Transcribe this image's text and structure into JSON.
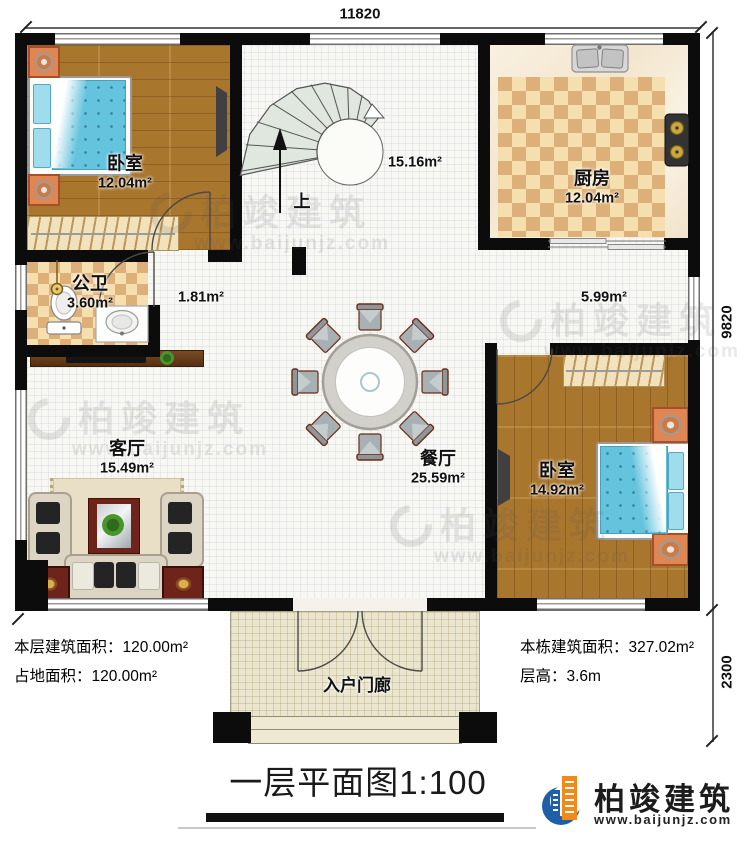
{
  "dimensions": {
    "width_top": "11820",
    "height_main": "9820",
    "height_porch": "2300"
  },
  "rooms": {
    "bedroom1": {
      "label": "卧室",
      "area": "12.04m²"
    },
    "stair_hall": {
      "area": "15.16m²",
      "up": "上"
    },
    "kitchen": {
      "label": "厨房",
      "area": "12.04m²"
    },
    "bathroom": {
      "label": "公卫",
      "area": "3.60m²"
    },
    "corridor_small": {
      "area": "1.81m²"
    },
    "corridor_right": {
      "area": "5.99m²"
    },
    "living_room": {
      "label": "客厅",
      "area": "15.49m²"
    },
    "dining_room": {
      "label": "餐厅",
      "area": "25.59m²"
    },
    "bedroom2": {
      "label": "卧室",
      "area": "14.92m²"
    },
    "porch": {
      "label": "入户门廊"
    }
  },
  "annotations": {
    "floor_area": "本层建筑面积：120.00m²",
    "land_area": "占地面积：120.00m²",
    "total_area": "本栋建筑面积：327.02m²",
    "floor_height": "层高：3.6m"
  },
  "title": "一层平面图1:100",
  "brand": {
    "name": "柏竣建筑",
    "url": "www.baijunjz.com"
  },
  "watermark": {
    "name": "柏竣建筑",
    "url": "www.baijunjz.com"
  },
  "colors": {
    "wall": "#0c0c0c",
    "wood_floor": "#a9762e",
    "tile_light": "#f5dfae",
    "tile_dark": "#ddb07a",
    "bed_blue": "#64c3dd",
    "brand_blue": "#1f5fa8",
    "brand_orange": "#f08a1d"
  }
}
